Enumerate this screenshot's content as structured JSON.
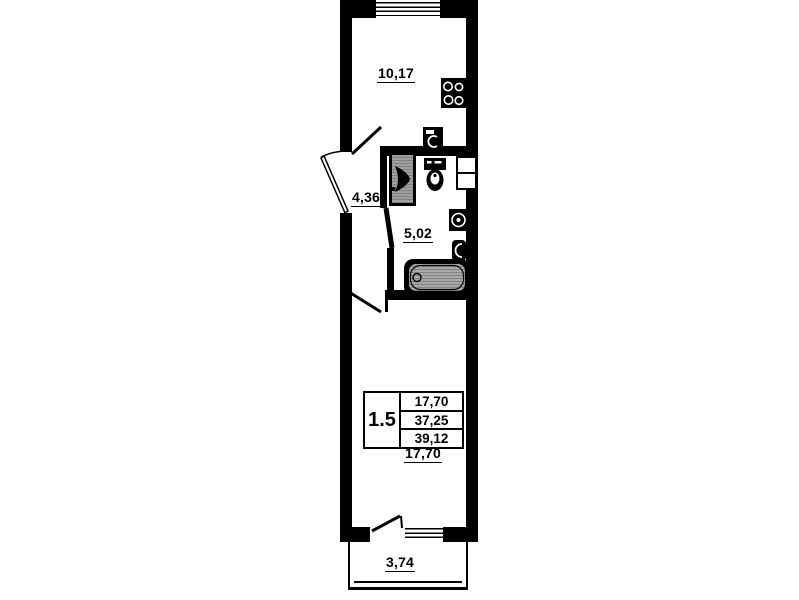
{
  "rooms": {
    "kitchen_area": "10,17",
    "hallway_area": "4,36",
    "bathroom_area": "5,02",
    "living_room_area": "17,70",
    "balcony_area": "3,74"
  },
  "stamp": {
    "apartment_type": "1.5",
    "living_area": "17,70",
    "apartment_area": "37,25",
    "total_area": "39,12"
  },
  "icons": {
    "stove": "stove-icon",
    "washing_machine": "washing-machine-icon",
    "washbasin": "washbasin-icon",
    "toilet": "toilet-icon",
    "sink": "sink-icon",
    "towel_rail": "towel-rail-icon",
    "bathtub": "bathtub-icon",
    "window": "window-icon",
    "door": "door-leaf-icon"
  },
  "colors": {
    "line": "#000000",
    "background": "#ffffff",
    "fixture_gray": "#a8a8a8"
  }
}
